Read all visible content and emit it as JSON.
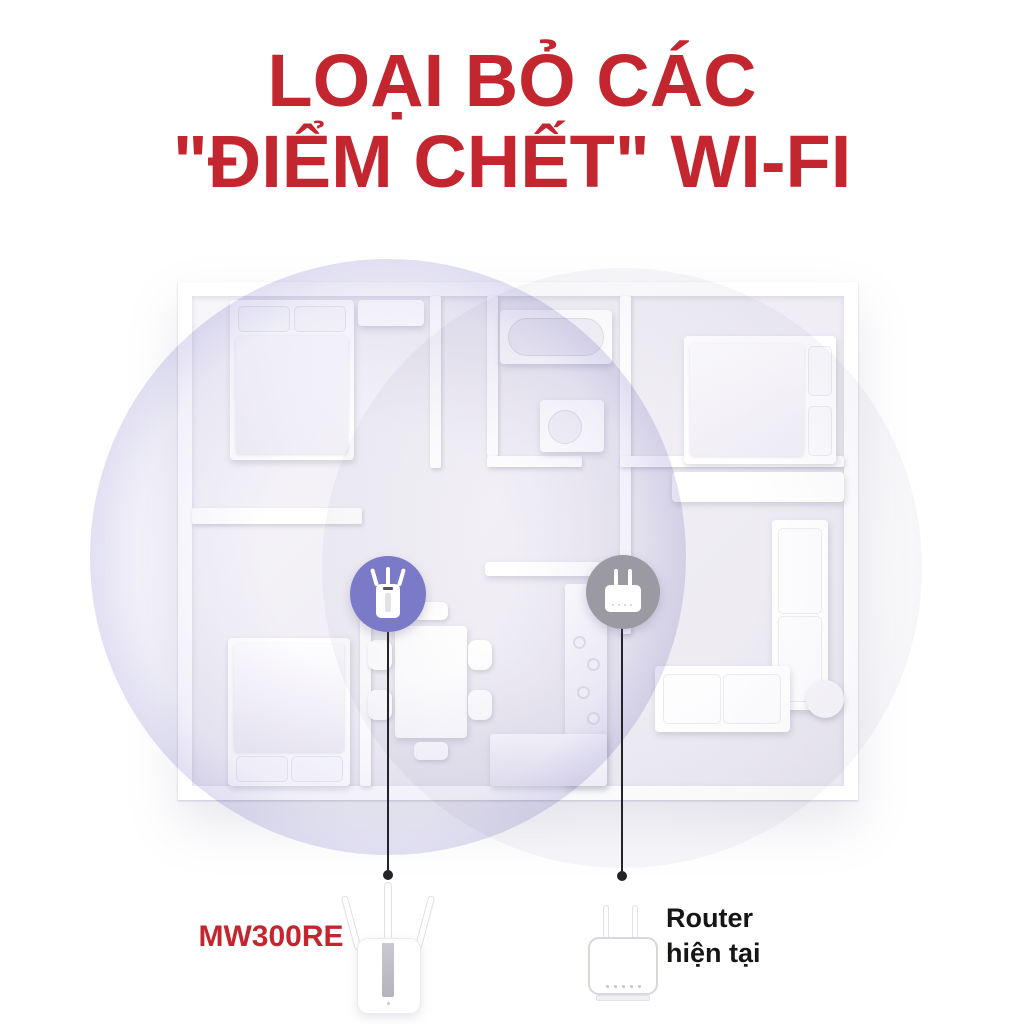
{
  "title": {
    "line1": "LOẠI BỎ CÁC",
    "line2": "\"ĐIỂM CHẾT\" WI-FI"
  },
  "devices": {
    "extender": {
      "model": "MW300RE",
      "icon": "extender-icon",
      "badge_color": "#7b7ac9"
    },
    "router": {
      "label_line1": "Router",
      "label_line2": "hiện tại",
      "icon": "router-icon",
      "badge_color": "#9b9aa2"
    }
  },
  "coverage": {
    "extender_zone_color": "#9892d2",
    "router_zone_color": "#dddce4"
  },
  "colors": {
    "title_red": "#c3262e",
    "badge_purple": "#7b7ac9",
    "badge_gray": "#9b9aa2",
    "label_black": "#161616",
    "line_color": "#232328"
  }
}
